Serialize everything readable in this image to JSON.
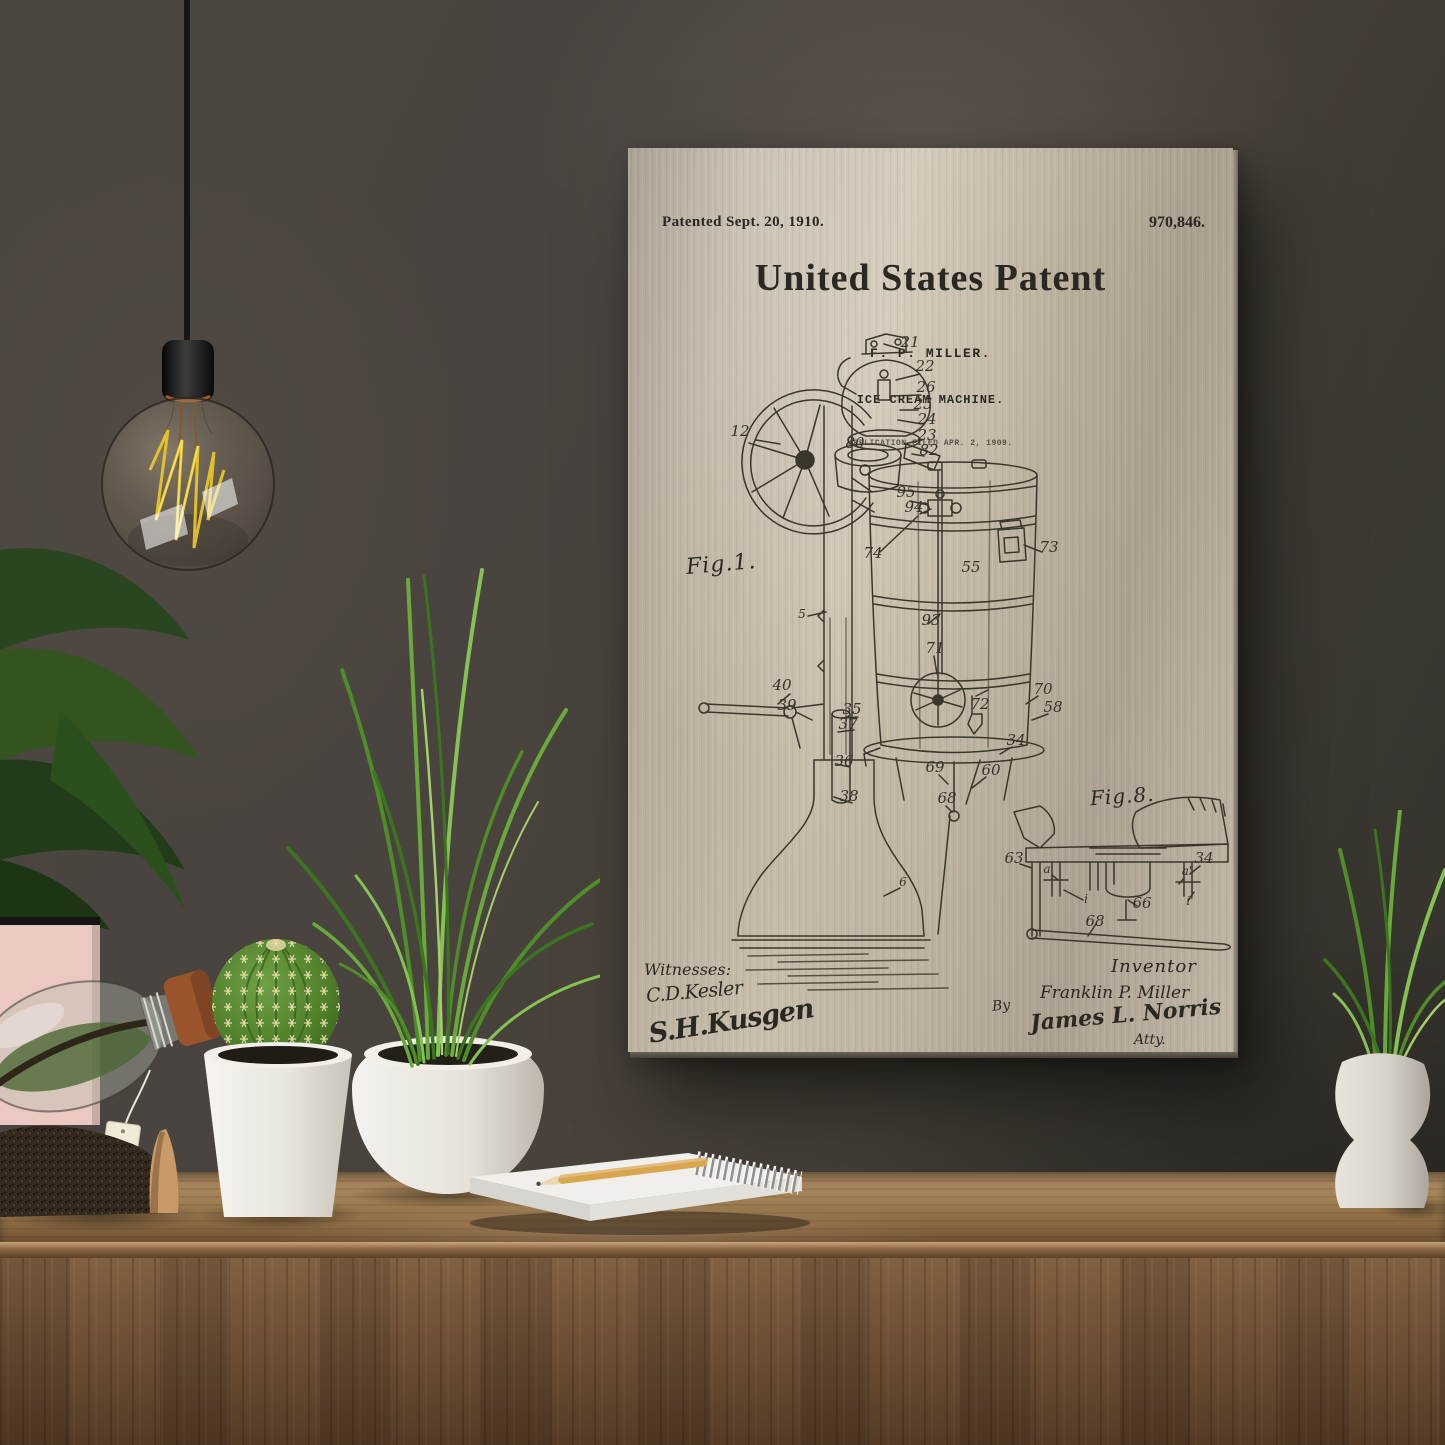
{
  "colors": {
    "wall": "#4a4540",
    "wall_dark": "#34312c",
    "metal_light": "#d2c9b8",
    "metal_mid": "#b8ae9d",
    "ink": "#2b2822",
    "desk_wood_top": "#8f6e49",
    "desk_wood_front": "#7b583a",
    "leaf_green_dark": "#2f5024",
    "grass_green": "#69a93c",
    "cactus_green": "#55822f",
    "filament_yellow": "#e9c92e",
    "cork_brown": "#9a552c",
    "pink_frame": "#ebc9c2",
    "pot_white": "#efece6"
  },
  "print": {
    "patented_line": "Patented Sept. 20, 1910.",
    "patent_number": "970,846.",
    "title": "United States Patent",
    "inventor_name_line": "F. P. MILLER.",
    "invention_title_line": "ICE CREAM MACHINE.",
    "application_line": "APPLICATION FILED APR. 2, 1909.",
    "fig1_label": "Fig.1.",
    "fig8_label": "Fig.8.",
    "witnesses_heading": "Witnesses:",
    "witness_signature_1": "C.D.Kesler",
    "witness_signature_2": "S.H.Kusgen",
    "inventor_heading": "Inventor",
    "inventor_signature": "Franklin P. Miller",
    "by_label": "By",
    "attorney_signature": "James L. Norris",
    "attorney_title": "Atty.",
    "part_labels": [
      {
        "t": "21",
        "x": 282,
        "y": 199
      },
      {
        "t": "22",
        "x": 297,
        "y": 223
      },
      {
        "t": "26",
        "x": 298,
        "y": 244
      },
      {
        "t": "25",
        "x": 295,
        "y": 261
      },
      {
        "t": "24",
        "x": 299,
        "y": 276
      },
      {
        "t": "23",
        "x": 299,
        "y": 292
      },
      {
        "t": "82",
        "x": 301,
        "y": 307
      },
      {
        "t": "12",
        "x": 112,
        "y": 288
      },
      {
        "t": "80",
        "x": 227,
        "y": 300
      },
      {
        "t": "95",
        "x": 278,
        "y": 349
      },
      {
        "t": "94",
        "x": 286,
        "y": 364
      },
      {
        "t": "74",
        "x": 245,
        "y": 410
      },
      {
        "t": "73",
        "x": 421,
        "y": 404
      },
      {
        "t": "55",
        "x": 343,
        "y": 424
      },
      {
        "t": "5",
        "x": 174,
        "y": 470
      },
      {
        "t": "93",
        "x": 303,
        "y": 477
      },
      {
        "t": "71",
        "x": 307,
        "y": 505
      },
      {
        "t": "40",
        "x": 154,
        "y": 542
      },
      {
        "t": "39",
        "x": 159,
        "y": 562
      },
      {
        "t": "35",
        "x": 224,
        "y": 566
      },
      {
        "t": "37",
        "x": 220,
        "y": 581
      },
      {
        "t": "72",
        "x": 352,
        "y": 561
      },
      {
        "t": "70",
        "x": 415,
        "y": 546
      },
      {
        "t": "58",
        "x": 425,
        "y": 564
      },
      {
        "t": "34",
        "x": 388,
        "y": 597
      },
      {
        "t": "36",
        "x": 216,
        "y": 618
      },
      {
        "t": "69",
        "x": 307,
        "y": 624
      },
      {
        "t": "60",
        "x": 363,
        "y": 627
      },
      {
        "t": "38",
        "x": 221,
        "y": 653
      },
      {
        "t": "68",
        "x": 319,
        "y": 655
      },
      {
        "t": "6",
        "x": 275,
        "y": 738
      },
      {
        "t": "63",
        "x": 386,
        "y": 715
      },
      {
        "t": "34",
        "x": 576,
        "y": 715
      },
      {
        "t": "a",
        "x": 419,
        "y": 725
      },
      {
        "t": "a'",
        "x": 559,
        "y": 727
      },
      {
        "t": "i",
        "x": 458,
        "y": 755
      },
      {
        "t": "i'",
        "x": 562,
        "y": 757
      },
      {
        "t": "66",
        "x": 514,
        "y": 760
      },
      {
        "t": "68",
        "x": 467,
        "y": 778
      }
    ]
  }
}
